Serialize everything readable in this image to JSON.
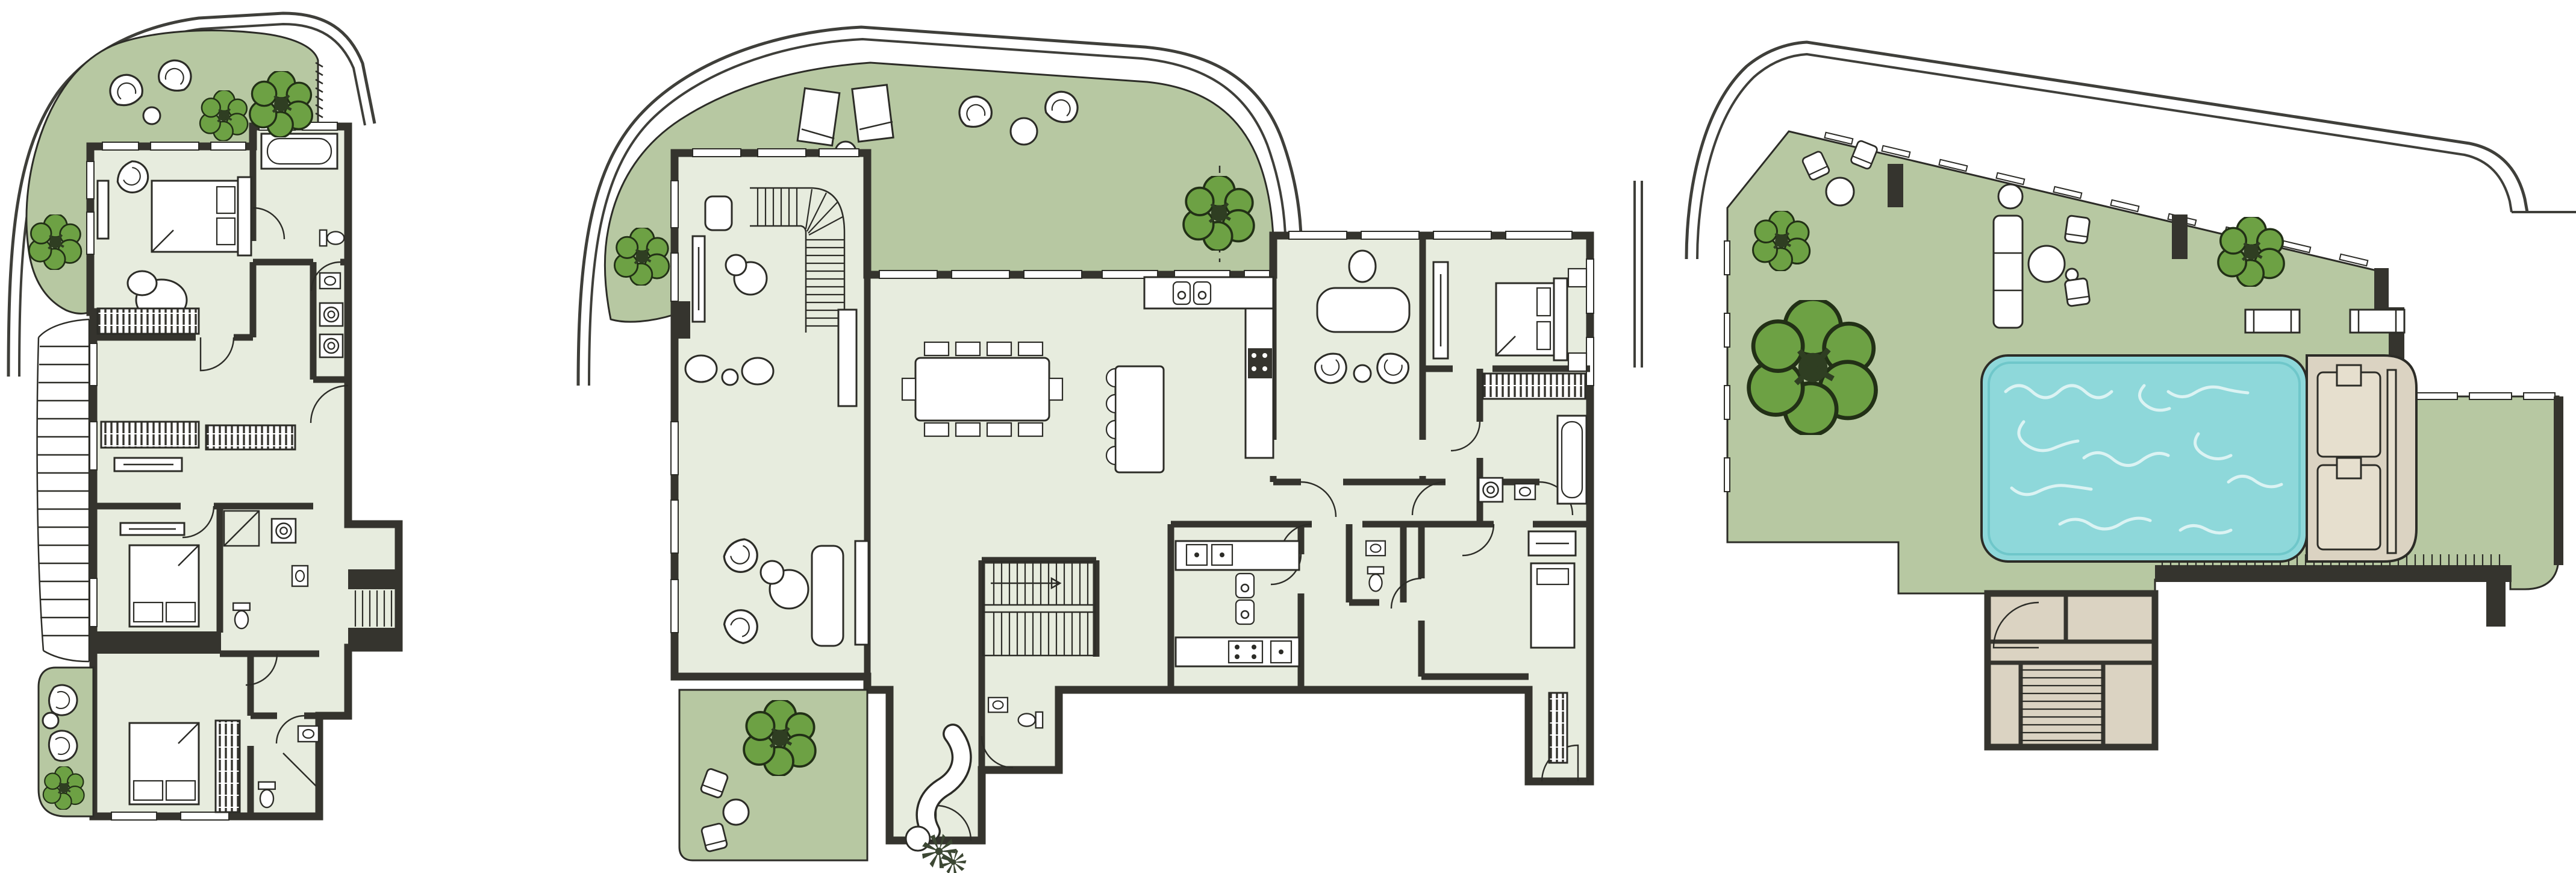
{
  "image": {
    "kind": "architectural floor plan sheet",
    "text_labels": [],
    "plan_count": 3
  },
  "colors": {
    "background": "#ffffff",
    "terrace_green": "#b7c8a2",
    "floor": "#e7ecde",
    "wall": "#35342e",
    "outline": "#2c2c27",
    "tree": "#6da144",
    "tree_dark": "#2f3e22",
    "pool_water": "#8ed8da",
    "pool_swirl": "#e9f8f8",
    "deck": "#dbd3c2",
    "deck_pad": "#e6dfce",
    "street": "#3f3f3a",
    "white": "#ffffff"
  },
  "plans": [
    {
      "id": "plan-bedroom-level",
      "icons": [
        "street-edge-icon",
        "roof-garden-icon",
        "tree-icon",
        "fan-chair-icon",
        "round-table-icon",
        "double-bed-icon",
        "wardrobe-hatch-icon",
        "bathtub-icon",
        "toilet-icon",
        "washbasin-icon",
        "shower-icon",
        "washer-icon",
        "side-stair-icon",
        "service-stair-icon",
        "balcony-icon",
        "door-swing-icon",
        "window-icon"
      ]
    },
    {
      "id": "plan-living-level",
      "icons": [
        "street-edge-icon",
        "roof-terrace-icon",
        "tree-icon",
        "sun-lounger-icon",
        "fan-chair-icon",
        "curved-stair-icon",
        "tv-sideboard-icon",
        "dining-table-10-seats-icon",
        "kitchen-island-icon",
        "bar-stool-icon",
        "double-sink-icon",
        "cooktop-icon",
        "oven-icon",
        "desk-icon",
        "office-chair-icon",
        "double-bed-icon",
        "wardrobe-hatch-icon",
        "bathtub-icon",
        "toilet-icon",
        "washbasin-icon",
        "washer-icon",
        "sofa-icon",
        "chaise-longue-icon",
        "palm-plant-icon",
        "straight-stair-icon",
        "balcony-icon",
        "entry-door-icon",
        "window-icon"
      ]
    },
    {
      "id": "plan-roof-terrace",
      "icons": [
        "street-edge-icon",
        "roof-terrace-icon",
        "tree-icon",
        "outdoor-sofa-icon",
        "round-table-icon",
        "lounge-chair-icon",
        "planter-icon",
        "swimming-pool-icon",
        "pool-deck-icon",
        "sun-platform-icon",
        "sun-lounger-icon",
        "railing-icon",
        "stair-enclosure-icon",
        "door-swing-icon"
      ]
    }
  ]
}
